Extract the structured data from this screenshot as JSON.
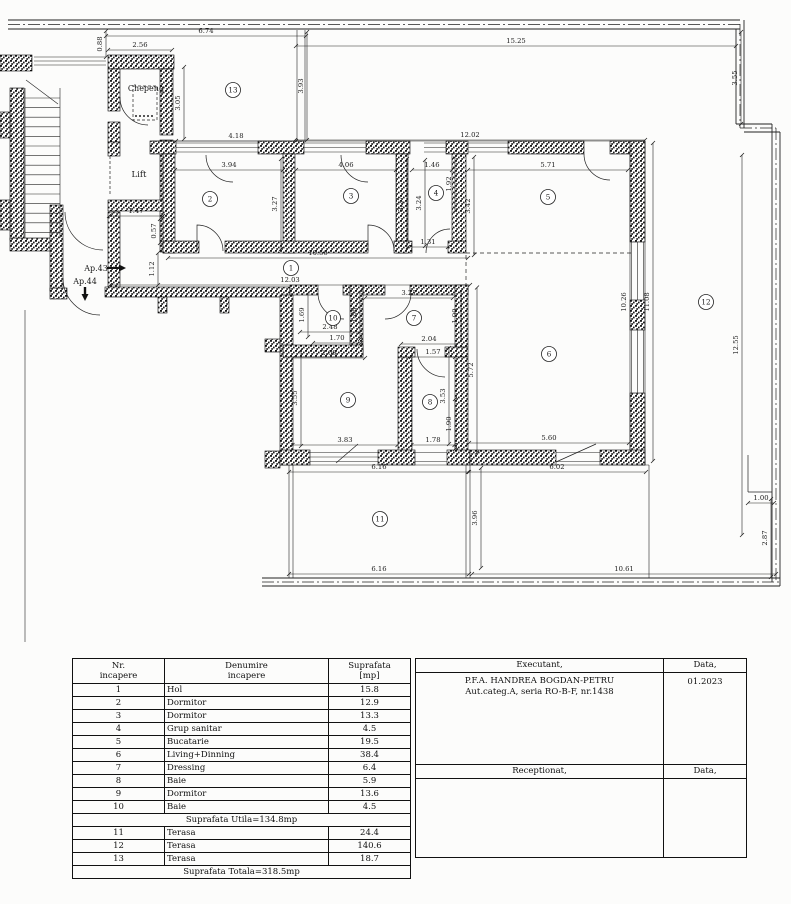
{
  "plan": {
    "labels": [
      {
        "t": "Chepeng",
        "x": 146,
        "y": 91,
        "s": 8
      },
      {
        "t": "Lift",
        "x": 139,
        "y": 177,
        "s": 8.5
      },
      {
        "t": "Ap.43",
        "x": 96,
        "y": 271,
        "s": 8
      },
      {
        "t": "Ap.44",
        "x": 85,
        "y": 284,
        "s": 8
      }
    ],
    "rooms": [
      {
        "n": "1",
        "x": 291,
        "y": 268
      },
      {
        "n": "2",
        "x": 210,
        "y": 199
      },
      {
        "n": "3",
        "x": 351,
        "y": 196
      },
      {
        "n": "4",
        "x": 436,
        "y": 193
      },
      {
        "n": "5",
        "x": 548,
        "y": 197
      },
      {
        "n": "6",
        "x": 549,
        "y": 354
      },
      {
        "n": "7",
        "x": 414,
        "y": 318
      },
      {
        "n": "8",
        "x": 430,
        "y": 402
      },
      {
        "n": "9",
        "x": 348,
        "y": 400
      },
      {
        "n": "10",
        "x": 333,
        "y": 318
      },
      {
        "n": "11",
        "x": 380,
        "y": 519
      },
      {
        "n": "12",
        "x": 706,
        "y": 302
      },
      {
        "n": "13",
        "x": 233,
        "y": 90
      }
    ],
    "dims": [
      {
        "v": "6.74",
        "x": 206,
        "y": 33,
        "o": "h",
        "l": 200
      },
      {
        "v": "15.25",
        "x": 516,
        "y": 43,
        "o": "h",
        "l": 440
      },
      {
        "v": "2.56",
        "x": 140,
        "y": 47,
        "o": "h",
        "l": 64
      },
      {
        "v": "4.18",
        "x": 236,
        "y": 138,
        "o": "h",
        "l": 120
      },
      {
        "v": "12.02",
        "x": 470,
        "y": 137,
        "o": "h",
        "l": 350
      },
      {
        "v": "3.94",
        "x": 229,
        "y": 167,
        "o": "h",
        "l": 108
      },
      {
        "v": "4.06",
        "x": 346,
        "y": 167,
        "o": "h",
        "l": 100
      },
      {
        "v": "1.46",
        "x": 432,
        "y": 167,
        "o": "h",
        "l": 40
      },
      {
        "v": "5.71",
        "x": 548,
        "y": 167,
        "o": "h",
        "l": 160
      },
      {
        "v": "1.47",
        "x": 136,
        "y": 213,
        "o": "h",
        "l": 54
      },
      {
        "v": "10.56",
        "x": 318,
        "y": 255,
        "o": "h",
        "l": 300
      },
      {
        "v": "12.03",
        "x": 290,
        "y": 282,
        "o": "h",
        "l": 360
      },
      {
        "v": "1.31",
        "x": 428,
        "y": 244,
        "o": "h",
        "l": 40
      },
      {
        "v": "2.48",
        "x": 330,
        "y": 329,
        "o": "h",
        "l": 60
      },
      {
        "v": "1.70",
        "x": 337,
        "y": 340,
        "o": "h",
        "l": 48
      },
      {
        "v": "3.27",
        "x": 409,
        "y": 295,
        "o": "h",
        "l": 88
      },
      {
        "v": "2.04",
        "x": 429,
        "y": 341,
        "o": "h",
        "l": 56
      },
      {
        "v": "1.57",
        "x": 433,
        "y": 354,
        "o": "h",
        "l": 44
      },
      {
        "v": "2.60",
        "x": 329,
        "y": 355,
        "o": "h",
        "l": 72
      },
      {
        "v": "3.83",
        "x": 345,
        "y": 442,
        "o": "h",
        "l": 105
      },
      {
        "v": "1.78",
        "x": 433,
        "y": 442,
        "o": "h",
        "l": 43
      },
      {
        "v": "5.60",
        "x": 549,
        "y": 440,
        "o": "h",
        "l": 160
      },
      {
        "v": "6.16",
        "x": 379,
        "y": 469,
        "o": "h",
        "l": 180
      },
      {
        "v": "6.02",
        "x": 557,
        "y": 469,
        "o": "h",
        "l": 178
      },
      {
        "v": "6.16",
        "x": 379,
        "y": 571,
        "o": "h",
        "l": 180
      },
      {
        "v": "10.61",
        "x": 624,
        "y": 571,
        "o": "h",
        "l": 304
      },
      {
        "v": "1.00",
        "x": 761,
        "y": 500,
        "o": "h",
        "l": 26
      },
      {
        "v": "0.88",
        "x": 102,
        "y": 44,
        "o": "v",
        "l": 26
      },
      {
        "v": "3.93",
        "x": 303,
        "y": 86,
        "o": "v",
        "l": 108
      },
      {
        "v": "3.55",
        "x": 737,
        "y": 78,
        "o": "v",
        "l": 92
      },
      {
        "v": "3.05",
        "x": 180,
        "y": 103,
        "o": "v",
        "l": 72
      },
      {
        "v": "3.27",
        "x": 277,
        "y": 204,
        "o": "v",
        "l": 90
      },
      {
        "v": "3.27",
        "x": 403,
        "y": 204,
        "o": "v",
        "l": 90
      },
      {
        "v": "3.24",
        "x": 421,
        "y": 203,
        "o": "v",
        "l": 86
      },
      {
        "v": "1.92",
        "x": 451,
        "y": 184,
        "o": "v",
        "l": 54
      },
      {
        "v": "3.42",
        "x": 470,
        "y": 206,
        "o": "v",
        "l": 98
      },
      {
        "v": "0.57",
        "x": 156,
        "y": 231,
        "o": "v",
        "l": 24
      },
      {
        "v": "1.12",
        "x": 154,
        "y": 269,
        "o": "v",
        "l": 32
      },
      {
        "v": "1.69",
        "x": 304,
        "y": 315,
        "o": "v",
        "l": 44
      },
      {
        "v": "1.88",
        "x": 356,
        "y": 315,
        "o": "v",
        "l": 48
      },
      {
        "v": "1.90",
        "x": 457,
        "y": 316,
        "o": "v",
        "l": 50
      },
      {
        "v": "3.55",
        "x": 297,
        "y": 398,
        "o": "v",
        "l": 96
      },
      {
        "v": "3.53",
        "x": 445,
        "y": 396,
        "o": "v",
        "l": 96
      },
      {
        "v": "1.90",
        "x": 451,
        "y": 424,
        "o": "v",
        "l": 50
      },
      {
        "v": "5.72",
        "x": 473,
        "y": 370,
        "o": "v",
        "l": 165
      },
      {
        "v": "3.96",
        "x": 477,
        "y": 518,
        "o": "v",
        "l": 100
      },
      {
        "v": "10.26",
        "x": 626,
        "y": 302,
        "o": "v",
        "l": 300
      },
      {
        "v": "11.08",
        "x": 649,
        "y": 302,
        "o": "v",
        "l": 318
      },
      {
        "v": "12.55",
        "x": 738,
        "y": 345,
        "o": "v",
        "l": 380
      },
      {
        "v": "2.87",
        "x": 767,
        "y": 538,
        "o": "v",
        "l": 78
      }
    ]
  },
  "table": {
    "headers": {
      "col1a": "Nr.",
      "col1b": "incapere",
      "col2a": "Denumire",
      "col2b": "incapere",
      "col3a": "Suprafata",
      "col3b": "[mp]"
    },
    "rows": [
      {
        "nr": "1",
        "name": "Hol",
        "area": "15.8"
      },
      {
        "nr": "2",
        "name": "Dormitor",
        "area": "12.9"
      },
      {
        "nr": "3",
        "name": "Dormitor",
        "area": "13.3"
      },
      {
        "nr": "4",
        "name": "Grup sanitar",
        "area": "4.5"
      },
      {
        "nr": "5",
        "name": "Bucatarie",
        "area": "19.5"
      },
      {
        "nr": "6",
        "name": "Living+Dinning",
        "area": "38.4"
      },
      {
        "nr": "7",
        "name": "Dressing",
        "area": "6.4"
      },
      {
        "nr": "8",
        "name": "Baie",
        "area": "5.9"
      },
      {
        "nr": "9",
        "name": "Dormitor",
        "area": "13.6"
      },
      {
        "nr": "10",
        "name": "Baie",
        "area": "4.5"
      }
    ],
    "subtotal": "Suprafata Utila=134.8mp",
    "terrace_rows": [
      {
        "nr": "11",
        "name": "Terasa",
        "area": "24.4"
      },
      {
        "nr": "12",
        "name": "Terasa",
        "area": "140.6"
      },
      {
        "nr": "13",
        "name": "Terasa",
        "area": "18.7"
      }
    ],
    "total": "Suprafata Totala=318.5mp"
  },
  "title_block": {
    "executant_label": "Executant,",
    "data_label": "Data,",
    "executant_name": "P.F.A. HANDREA BOGDAN-PETRU",
    "executant_details": "Aut.categ.A, seria RO-B-F, nr.1438",
    "date_value": "01.2023",
    "receptionat_label": "Receptionat,",
    "data_label2": "Data,"
  }
}
